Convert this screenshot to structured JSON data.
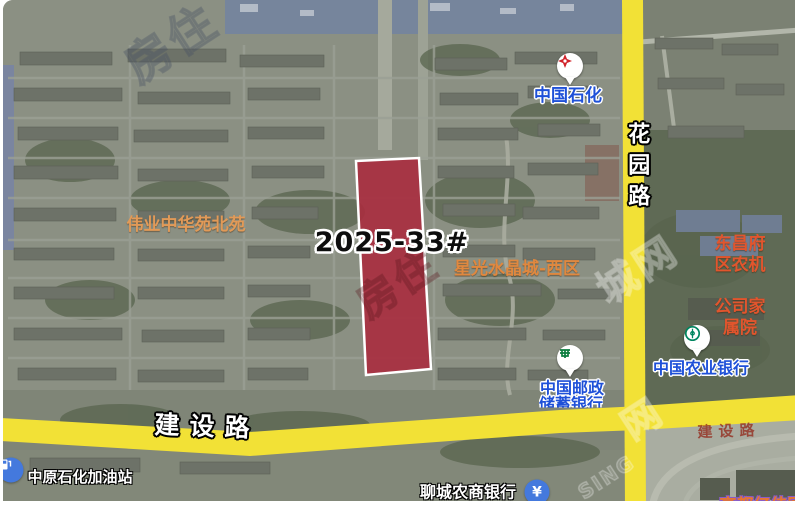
{
  "map": {
    "parcel": {
      "label": "2025-33#",
      "fill_color": "#a92d3e",
      "border_color": "#ffffff"
    },
    "roads": {
      "color": "#f2e136",
      "vertical": {
        "label": "花园路"
      },
      "horizontal": {
        "label": "建设路"
      },
      "horizontal_faded": {
        "label": "建设路"
      }
    },
    "neighborhood_labels": {
      "weiye": {
        "label": "伟业中华苑北苑",
        "color": "#e19a58"
      },
      "xingguang": {
        "label": "星光水晶城-西区",
        "color": "#e0883f"
      },
      "nongji": {
        "line1": "东昌府区农机",
        "line2": "公司家属院",
        "color": "#e2552d"
      },
      "partial_bottom_right": {
        "label": "高都亿佳园",
        "color": "#e6762f"
      }
    },
    "pois": {
      "sinopec": {
        "label": "中国石化",
        "color": "#1e50d8"
      },
      "abc_bank": {
        "label": "中国农业银行",
        "color": "#1e50d8"
      },
      "postal_bank": {
        "line1": "中国邮政",
        "line2": "储蓄银行",
        "color": "#1e50d8"
      },
      "gas_station": {
        "label": "中原石化加油站"
      },
      "rural_bank": {
        "label": "聊城农商银行",
        "icon_symbol": "¥"
      }
    },
    "watermark": {
      "fragments": [
        "房住",
        "城网",
        "网",
        "SING"
      ]
    }
  }
}
